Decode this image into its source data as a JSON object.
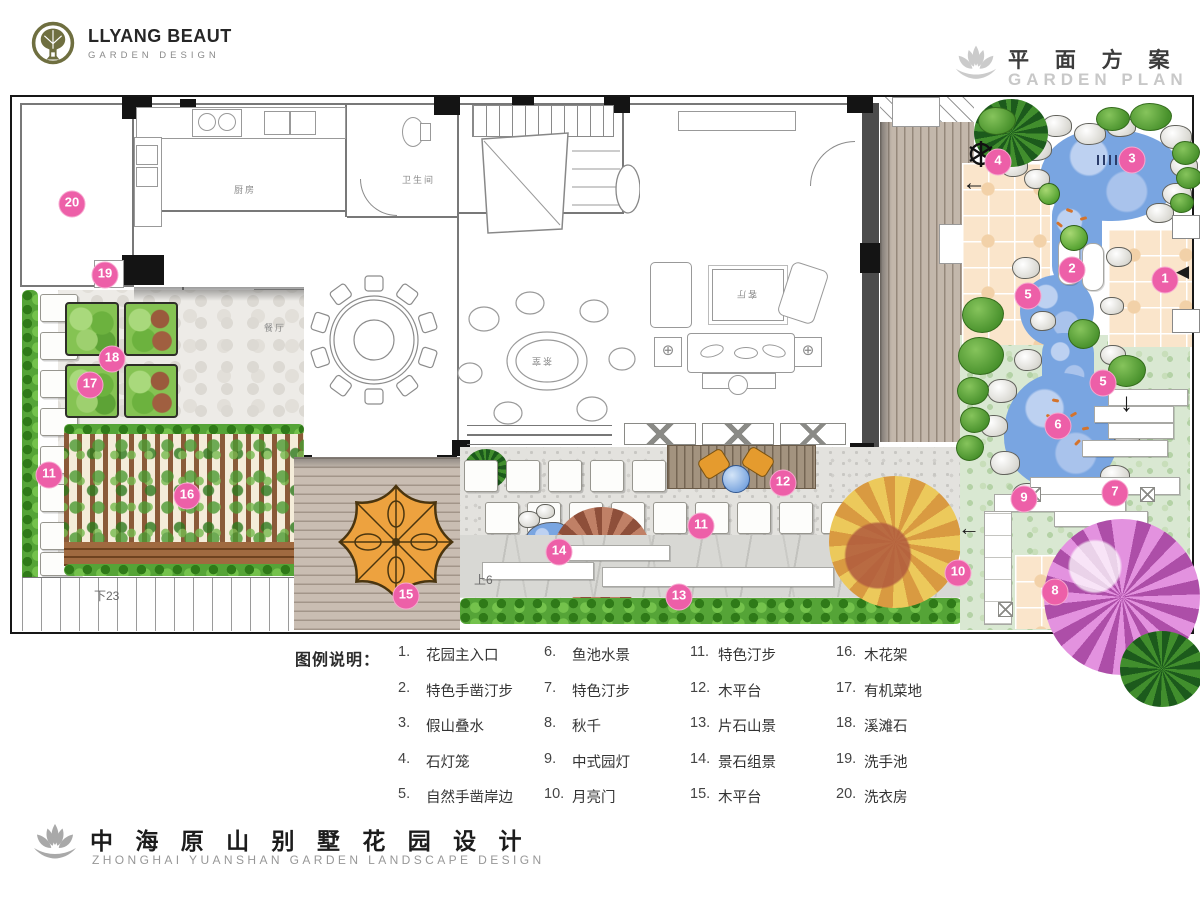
{
  "header": {
    "logo": {
      "title": "LLYANG BEAUT",
      "subtitle": "GARDEN DESIGN"
    },
    "plan_title_cn": "平 面 方 案",
    "plan_title_en": "GARDEN PLAN"
  },
  "footer": {
    "title_cn": "中 海 原 山 别 墅 花 园 设 计",
    "title_en": "ZHONGHAI YUANSHAN GARDEN LANDSCAPE DESIGN"
  },
  "legend": {
    "heading": "图例说明：",
    "items": [
      {
        "num": "1.",
        "label": "花园主入口"
      },
      {
        "num": "2.",
        "label": "特色手凿汀步"
      },
      {
        "num": "3.",
        "label": "假山叠水"
      },
      {
        "num": "4.",
        "label": "石灯笼"
      },
      {
        "num": "5.",
        "label": "自然手凿岸边"
      },
      {
        "num": "6.",
        "label": "鱼池水景"
      },
      {
        "num": "7.",
        "label": "特色汀步"
      },
      {
        "num": "8.",
        "label": "秋千"
      },
      {
        "num": "9.",
        "label": "中式园灯"
      },
      {
        "num": "10.",
        "label": "月亮门"
      },
      {
        "num": "11.",
        "label": "特色汀步"
      },
      {
        "num": "12.",
        "label": "木平台"
      },
      {
        "num": "13.",
        "label": "片石山景"
      },
      {
        "num": "14.",
        "label": "景石组景"
      },
      {
        "num": "15.",
        "label": "木平台"
      },
      {
        "num": "16.",
        "label": "木花架"
      },
      {
        "num": "17.",
        "label": "有机菜地"
      },
      {
        "num": "18.",
        "label": "溪滩石"
      },
      {
        "num": "19.",
        "label": "洗手池"
      },
      {
        "num": "20.",
        "label": "洗衣房"
      }
    ]
  },
  "plan": {
    "markers": [
      {
        "n": "20",
        "x": 60,
        "y": 107
      },
      {
        "n": "19",
        "x": 93,
        "y": 178
      },
      {
        "n": "18",
        "x": 100,
        "y": 262
      },
      {
        "n": "17",
        "x": 78,
        "y": 288
      },
      {
        "n": "16",
        "x": 175,
        "y": 399
      },
      {
        "n": "15",
        "x": 394,
        "y": 499
      },
      {
        "n": "14",
        "x": 547,
        "y": 455
      },
      {
        "n": "13",
        "x": 667,
        "y": 500
      },
      {
        "n": "12",
        "x": 771,
        "y": 386
      },
      {
        "n": "11",
        "x": 689,
        "y": 429
      },
      {
        "n": "11",
        "x": 37,
        "y": 378
      },
      {
        "n": "10",
        "x": 946,
        "y": 476
      },
      {
        "n": "9",
        "x": 1012,
        "y": 402
      },
      {
        "n": "8",
        "x": 1043,
        "y": 495
      },
      {
        "n": "7",
        "x": 1103,
        "y": 396
      },
      {
        "n": "6",
        "x": 1046,
        "y": 329
      },
      {
        "n": "5",
        "x": 1016,
        "y": 199
      },
      {
        "n": "5",
        "x": 1091,
        "y": 286
      },
      {
        "n": "4",
        "x": 986,
        "y": 65
      },
      {
        "n": "3",
        "x": 1120,
        "y": 63
      },
      {
        "n": "2",
        "x": 1060,
        "y": 173
      },
      {
        "n": "1",
        "x": 1153,
        "y": 183
      }
    ],
    "room_labels": [
      {
        "text": "厨房"
      },
      {
        "text": "卫生间"
      },
      {
        "text": "餐厅"
      },
      {
        "text": "茶室"
      },
      {
        "text": "客厅"
      }
    ],
    "stair_down": "下23",
    "stair_up": "上6"
  },
  "colors": {
    "marker_pink": "#ed5fa8",
    "pond_blue": "#79a5e1",
    "lawn_green": "#d9e8d2",
    "tile_peach": "#fae5cb",
    "hedge_green": "#55a437",
    "deck_tan": "#c3b7ab",
    "logo_olive": "#6f6f40",
    "title_gray": "#c8c8c8"
  }
}
